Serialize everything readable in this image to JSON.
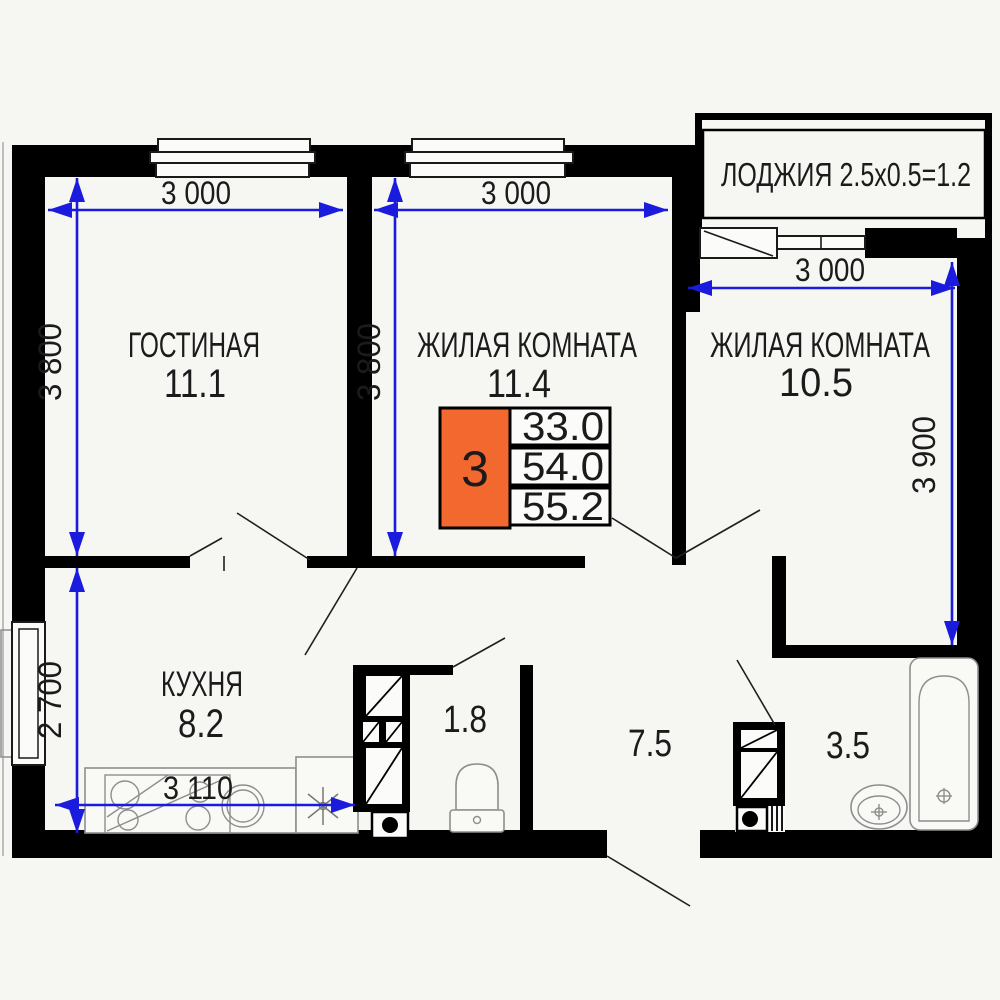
{
  "rooms": {
    "living": {
      "name": "ГОСТИНАЯ",
      "area": "11.1"
    },
    "bedroom1": {
      "name": "ЖИЛАЯ КОМНАТА",
      "area": "11.4"
    },
    "bedroom2": {
      "name": "ЖИЛАЯ КОМНАТА",
      "area": "10.5"
    },
    "kitchen": {
      "name": "КУХНЯ",
      "area": "8.2"
    },
    "wc": {
      "area": "1.8"
    },
    "hallway": {
      "area": "7.5"
    },
    "bathroom": {
      "area": "3.5"
    },
    "loggia": {
      "label": "ЛОДЖИЯ 2.5x0.5=1.2"
    }
  },
  "info_badge": {
    "room_count": "3",
    "living_area": "33.0",
    "apartment_area": "54.0",
    "total_area": "55.2"
  },
  "dimensions": {
    "living_width": "3 000",
    "bedroom1_width": "3 000",
    "bedroom2_width": "3 000",
    "living_height": "3 800",
    "bedroom1_height": "3 800",
    "bedroom2_height": "3 900",
    "kitchen_height": "2 700",
    "kitchen_width": "3 110"
  },
  "colors": {
    "wall": "#000000",
    "dimension_blue": "#1b1bdd",
    "badge_orange": "#f3682f",
    "background": "#f6f6f3"
  }
}
